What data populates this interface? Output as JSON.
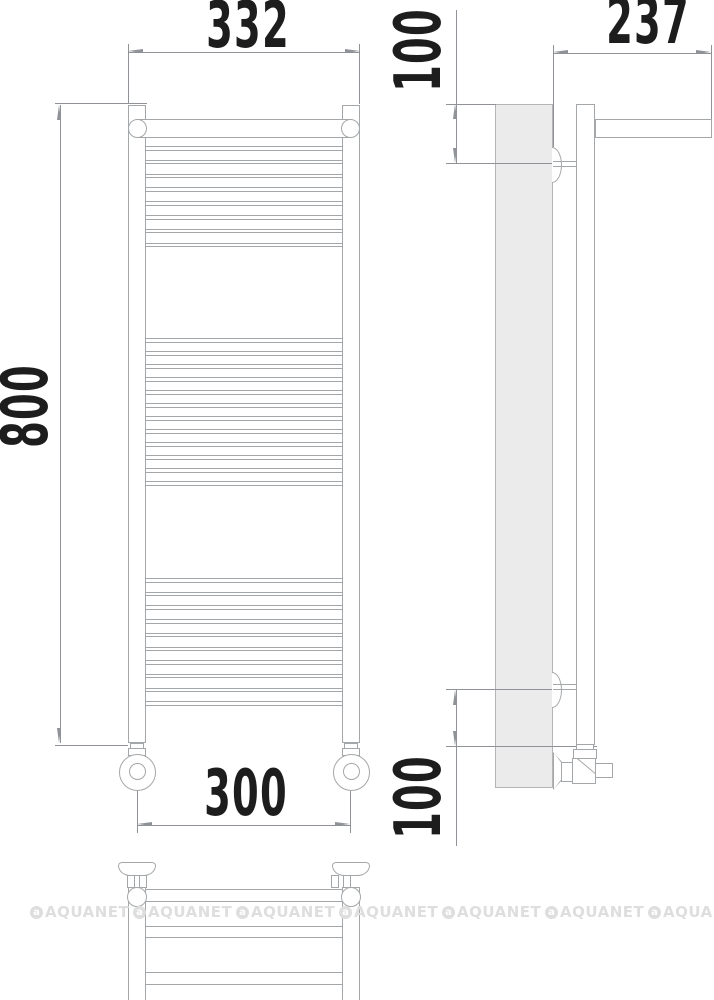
{
  "drawing": {
    "type": "technical-drawing-towel-rail",
    "dimensions": {
      "top_width": "332",
      "height": "800",
      "bottom_width": "300",
      "depth": "237",
      "top_offset": "100",
      "bottom_offset": "100"
    }
  },
  "watermark": {
    "text": "AQUANET",
    "count": 7,
    "logo_glyph": "a"
  },
  "views": {
    "front": {
      "rung_groups": [
        {
          "count": 8,
          "start": 146,
          "pitch": 13.8
        },
        {
          "count": 12,
          "start": 338,
          "pitch": 13.0
        },
        {
          "count": 10,
          "start": 578,
          "pitch": 13.7
        }
      ]
    },
    "bottom": {
      "tubes": [
        {
          "top": 889,
          "height": 13
        },
        {
          "top": 926,
          "height": 12
        },
        {
          "top": 972,
          "height": 13
        }
      ]
    }
  },
  "colors": {
    "line": "#a4a7a9",
    "dim": "#8f9296",
    "text": "#1d1d1d",
    "wall_fill": "#ebebeb",
    "wall_border": "#b5b5b5",
    "wm": "#dedede"
  }
}
